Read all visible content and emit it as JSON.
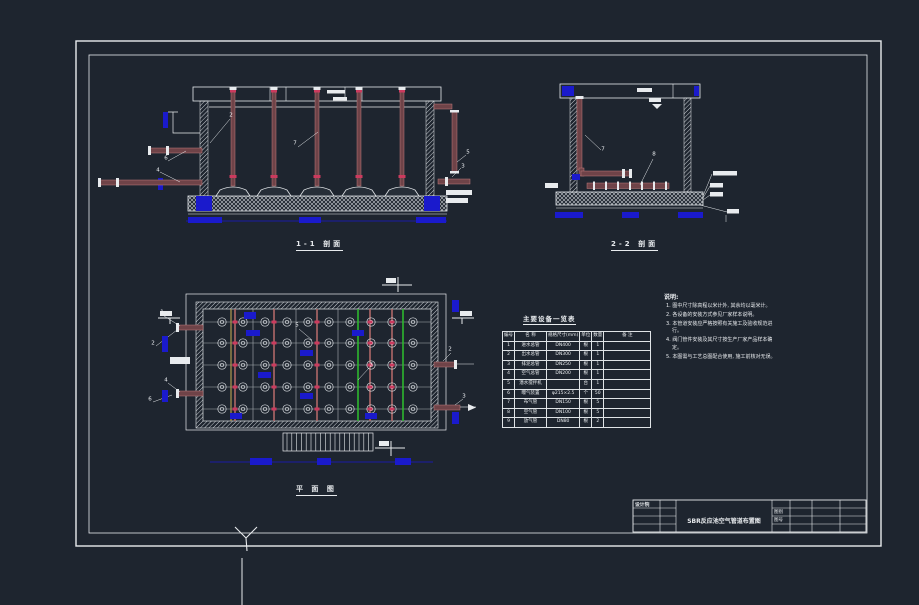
{
  "app": {
    "background": "#1e252f",
    "line_color": "#e8ebee",
    "dimension_blue": "#1a1acc",
    "pipe_maroon": "#6f4348",
    "pipe_edge": "#c07c7c",
    "flange_red": "#cc3a5e",
    "pipe_green": "#2eb82e"
  },
  "views": {
    "section_1_1": {
      "title": "1-1 剖面"
    },
    "section_2_2": {
      "title": "2-2 剖面"
    },
    "plan": {
      "title": "平 面 图"
    }
  },
  "table": {
    "title": "主要设备一览表",
    "headers": [
      "编号",
      "名  称",
      "规格尺寸(mm)",
      "单位",
      "数量",
      "备  注"
    ],
    "rows": [
      [
        "1",
        "进水总管",
        "DN400",
        "根",
        "1",
        ""
      ],
      [
        "2",
        "出水总管",
        "DN300",
        "根",
        "1",
        ""
      ],
      [
        "3",
        "排泥总管",
        "DN250",
        "根",
        "1",
        ""
      ],
      [
        "4",
        "空气总管",
        "DN200",
        "根",
        "1",
        ""
      ],
      [
        "5",
        "潜水搅拌机",
        "",
        "台",
        "1",
        ""
      ],
      [
        "6",
        "曝气装置",
        "φ215×2.5",
        "个",
        "50",
        ""
      ],
      [
        "7",
        "布气管",
        "DN150",
        "根",
        "5",
        ""
      ],
      [
        "8",
        "空气管",
        "DN100",
        "根",
        "5",
        ""
      ],
      [
        "9",
        "放气管",
        "DN80",
        "根",
        "2",
        ""
      ]
    ]
  },
  "notes": {
    "heading": "说明:",
    "items": [
      "1. 图中尺寸除高程以米计外, 其余均以毫米计。",
      "2. 各设备的安装方式参见厂家样本说明。",
      "3. 本管道安装应严格按照有关施工及验收规范进行。",
      "4. 阀门管件安装及其尺寸按生产厂家产品样本确定。",
      "5. 本图需与工艺总图配合使用, 施工前核对无误。"
    ]
  },
  "title_block": {
    "org": "设计院",
    "drawing_title": "SBR反应池空气管道布置图",
    "sheet_type_label": "图别",
    "sheet_no_label": "图号"
  },
  "callouts": {
    "section_1_1": [
      {
        "n": "2",
        "x": 231,
        "y": 116
      },
      {
        "n": "7",
        "x": 295,
        "y": 144
      },
      {
        "n": "6",
        "x": 166,
        "y": 159
      },
      {
        "n": "4",
        "x": 158,
        "y": 171
      },
      {
        "n": "5",
        "x": 468,
        "y": 153
      },
      {
        "n": "3",
        "x": 463,
        "y": 167
      }
    ],
    "section_2_2": [
      {
        "n": "7",
        "x": 603,
        "y": 150
      },
      {
        "n": "8",
        "x": 654,
        "y": 155
      }
    ],
    "plan": [
      {
        "n": "1",
        "x": 162,
        "y": 313
      },
      {
        "n": "2",
        "x": 153,
        "y": 344
      },
      {
        "n": "4",
        "x": 166,
        "y": 381
      },
      {
        "n": "6",
        "x": 150,
        "y": 400
      },
      {
        "n": "5",
        "x": 297,
        "y": 326
      },
      {
        "n": "7",
        "x": 371,
        "y": 366
      },
      {
        "n": "2",
        "x": 450,
        "y": 350
      },
      {
        "n": "3",
        "x": 464,
        "y": 397
      }
    ]
  }
}
